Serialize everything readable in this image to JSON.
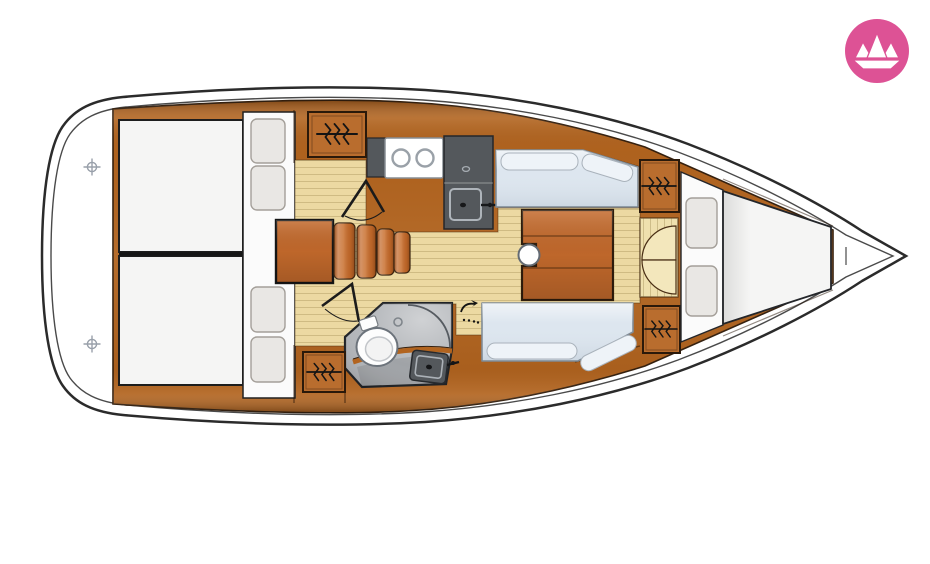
{
  "page": {
    "background": "#ffffff",
    "description_label": ""
  },
  "logo": {
    "icon": "paper-boat-icon",
    "bg_color": "#dd5295",
    "glyph_color": "#ffffff"
  },
  "icons": {
    "deck_fitting": "deck-hatch-icon",
    "wardrobe": "hanging-locker-icon",
    "door_swing": "door-swing-arrow-icon",
    "mast": "mast-post-icon"
  },
  "colors": {
    "hull_fill": "#ffffff",
    "hull_outline": "#2b2b2b",
    "toe_rail": "#4a4a4a",
    "wood": "#b2641f",
    "cabinet_wood": "#b96d2e",
    "table_wood": "#c46a2c",
    "floor": "#ecd9a2",
    "floor_light": "#efe0ae",
    "door_leaf": "#f3e7bc",
    "mattress": "#f5f5f4",
    "platform_white": "#fbfbfb",
    "pillow": "#e9e7e4",
    "settee": "#dde6ef",
    "cushion_top": "#eef3f8",
    "counter_gray": "#54585c",
    "stove_white": "#ffffff",
    "bath_floor": "#b3b6ba",
    "toilet_white": "#fdfdfd",
    "symbol_ink": "#141414"
  }
}
